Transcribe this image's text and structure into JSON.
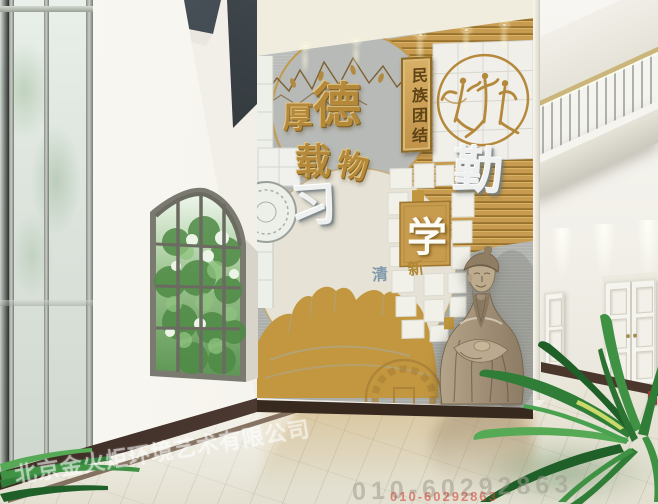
{
  "mural": {
    "motto_chars": [
      "厚",
      "德",
      "载",
      "物"
    ],
    "plaque_text": "民族团结",
    "char_diligence": "勤",
    "char_study": "学",
    "char_practice": "习",
    "char_new": "新",
    "char_clear": "清"
  },
  "watermark": {
    "company": "北京金火炬环境艺术有限公司",
    "phone": "010-60292863"
  },
  "colors": {
    "gold_slat": "#c89c50",
    "gold_dark": "#96722e",
    "stone_grey": "#b6b9b6",
    "cream_blob": "#e6e2d5",
    "wall_white": "#f3f1ea",
    "baseboard_brown": "#46332a",
    "floor_cream": "#ebe8d9",
    "statue_tan": "#a8977f",
    "leaf_green": "#2f7d37",
    "handrail_gold": "#cab67b",
    "accent_red": "#b3342e"
  }
}
